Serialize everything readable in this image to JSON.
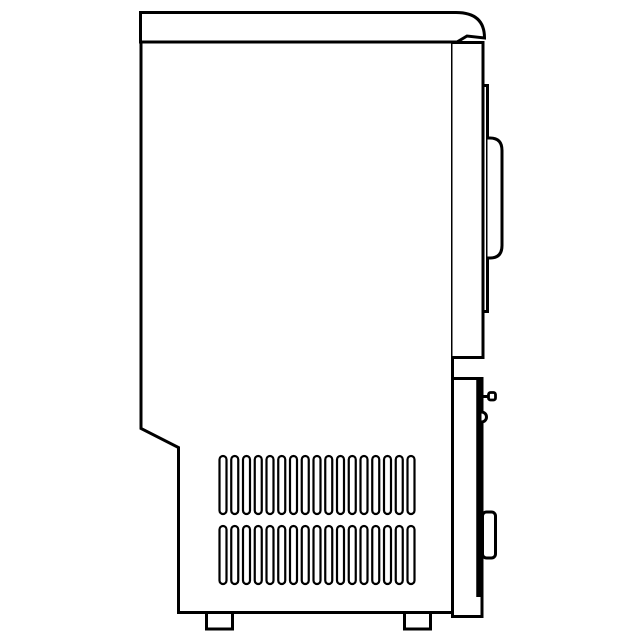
{
  "meta": {
    "title": "Appliance side-view line drawing",
    "description": "Black-and-white technical line drawing of a countertop ice maker / compact appliance seen from the right side: flat lid with rounded front corner, tall cabinet with chamfered lower-back corner, front door with pull handle, lower service panel with hinge pin, latch notch and grip, two rows of ventilation slots, and two support feet"
  },
  "colors": {
    "background": "#ffffff",
    "line": "#000000"
  },
  "parts": {
    "lid": "top lid with rounded front corner and hinge lip",
    "cabinet_body": "main cabinet shell with chamfered lower-back corner",
    "upper_door": "upper front door panel",
    "door_face": "door front face step",
    "door_handle": "door pull handle",
    "door_gap": "recess between door and lower panel",
    "lower_panel": "lower front service panel",
    "hinge_pin": "hinge pin stub",
    "latch_notch": "latch bump",
    "panel_grip": "lower panel grip bar",
    "vent_grid": "two rows of ventilation slots",
    "feet": "two support feet"
  },
  "vents": {
    "slots_per_row": 17,
    "start_x": 219.5,
    "spacing": 11.75,
    "slot_width": 7,
    "slot_height": 58,
    "corner_radius": 3.5,
    "rows": [
      {
        "y": 456
      },
      {
        "y": 526
      }
    ]
  },
  "feet": {
    "count": 2,
    "positions_x": [
      206.5,
      404.5
    ],
    "y": 612.5,
    "width": 26,
    "height": 16.5
  }
}
